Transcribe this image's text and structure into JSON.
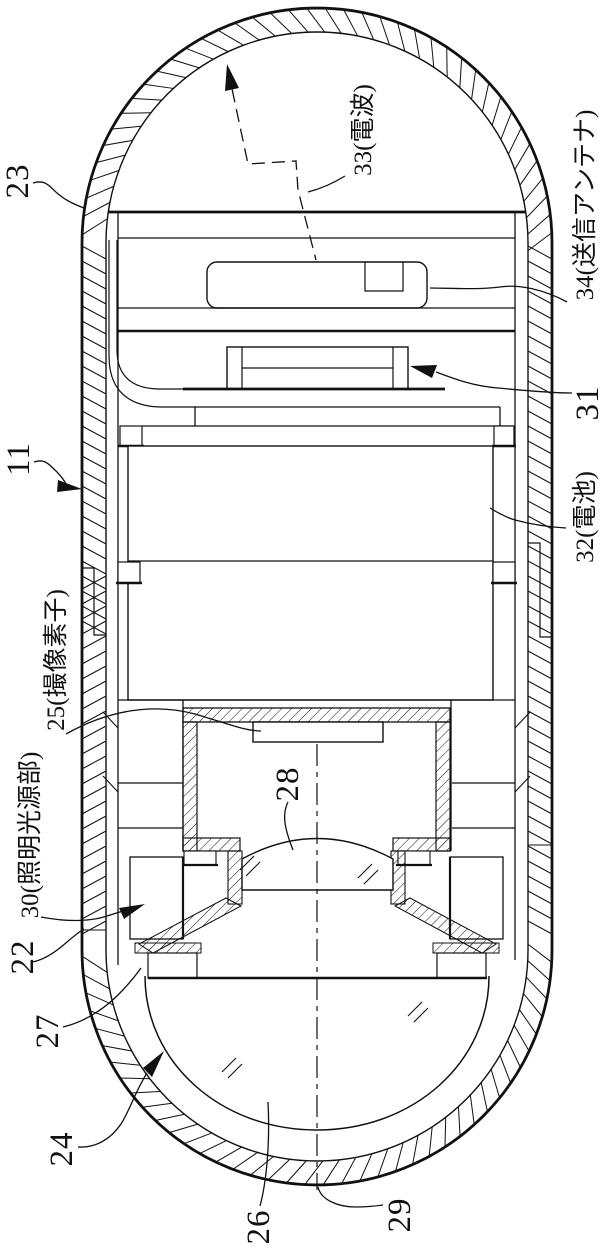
{
  "figure": {
    "type": "patent-cross-section-drawing",
    "line_color": "#111111",
    "background_color": "#ffffff",
    "labels": [
      {
        "id": "23",
        "text": "23"
      },
      {
        "id": "33",
        "text": "33(電波)"
      },
      {
        "id": "34",
        "text": "34(送信アンテナ)"
      },
      {
        "id": "11",
        "text": "11"
      },
      {
        "id": "31",
        "text": "31"
      },
      {
        "id": "32",
        "text": "32(電池)"
      },
      {
        "id": "25",
        "text": "25(撮像素子)"
      },
      {
        "id": "28",
        "text": "28"
      },
      {
        "id": "30",
        "text": "30(照明光源部)"
      },
      {
        "id": "22",
        "text": "22"
      },
      {
        "id": "27",
        "text": "27"
      },
      {
        "id": "24",
        "text": "24"
      },
      {
        "id": "26",
        "text": "26"
      },
      {
        "id": "29",
        "text": "29"
      }
    ]
  }
}
